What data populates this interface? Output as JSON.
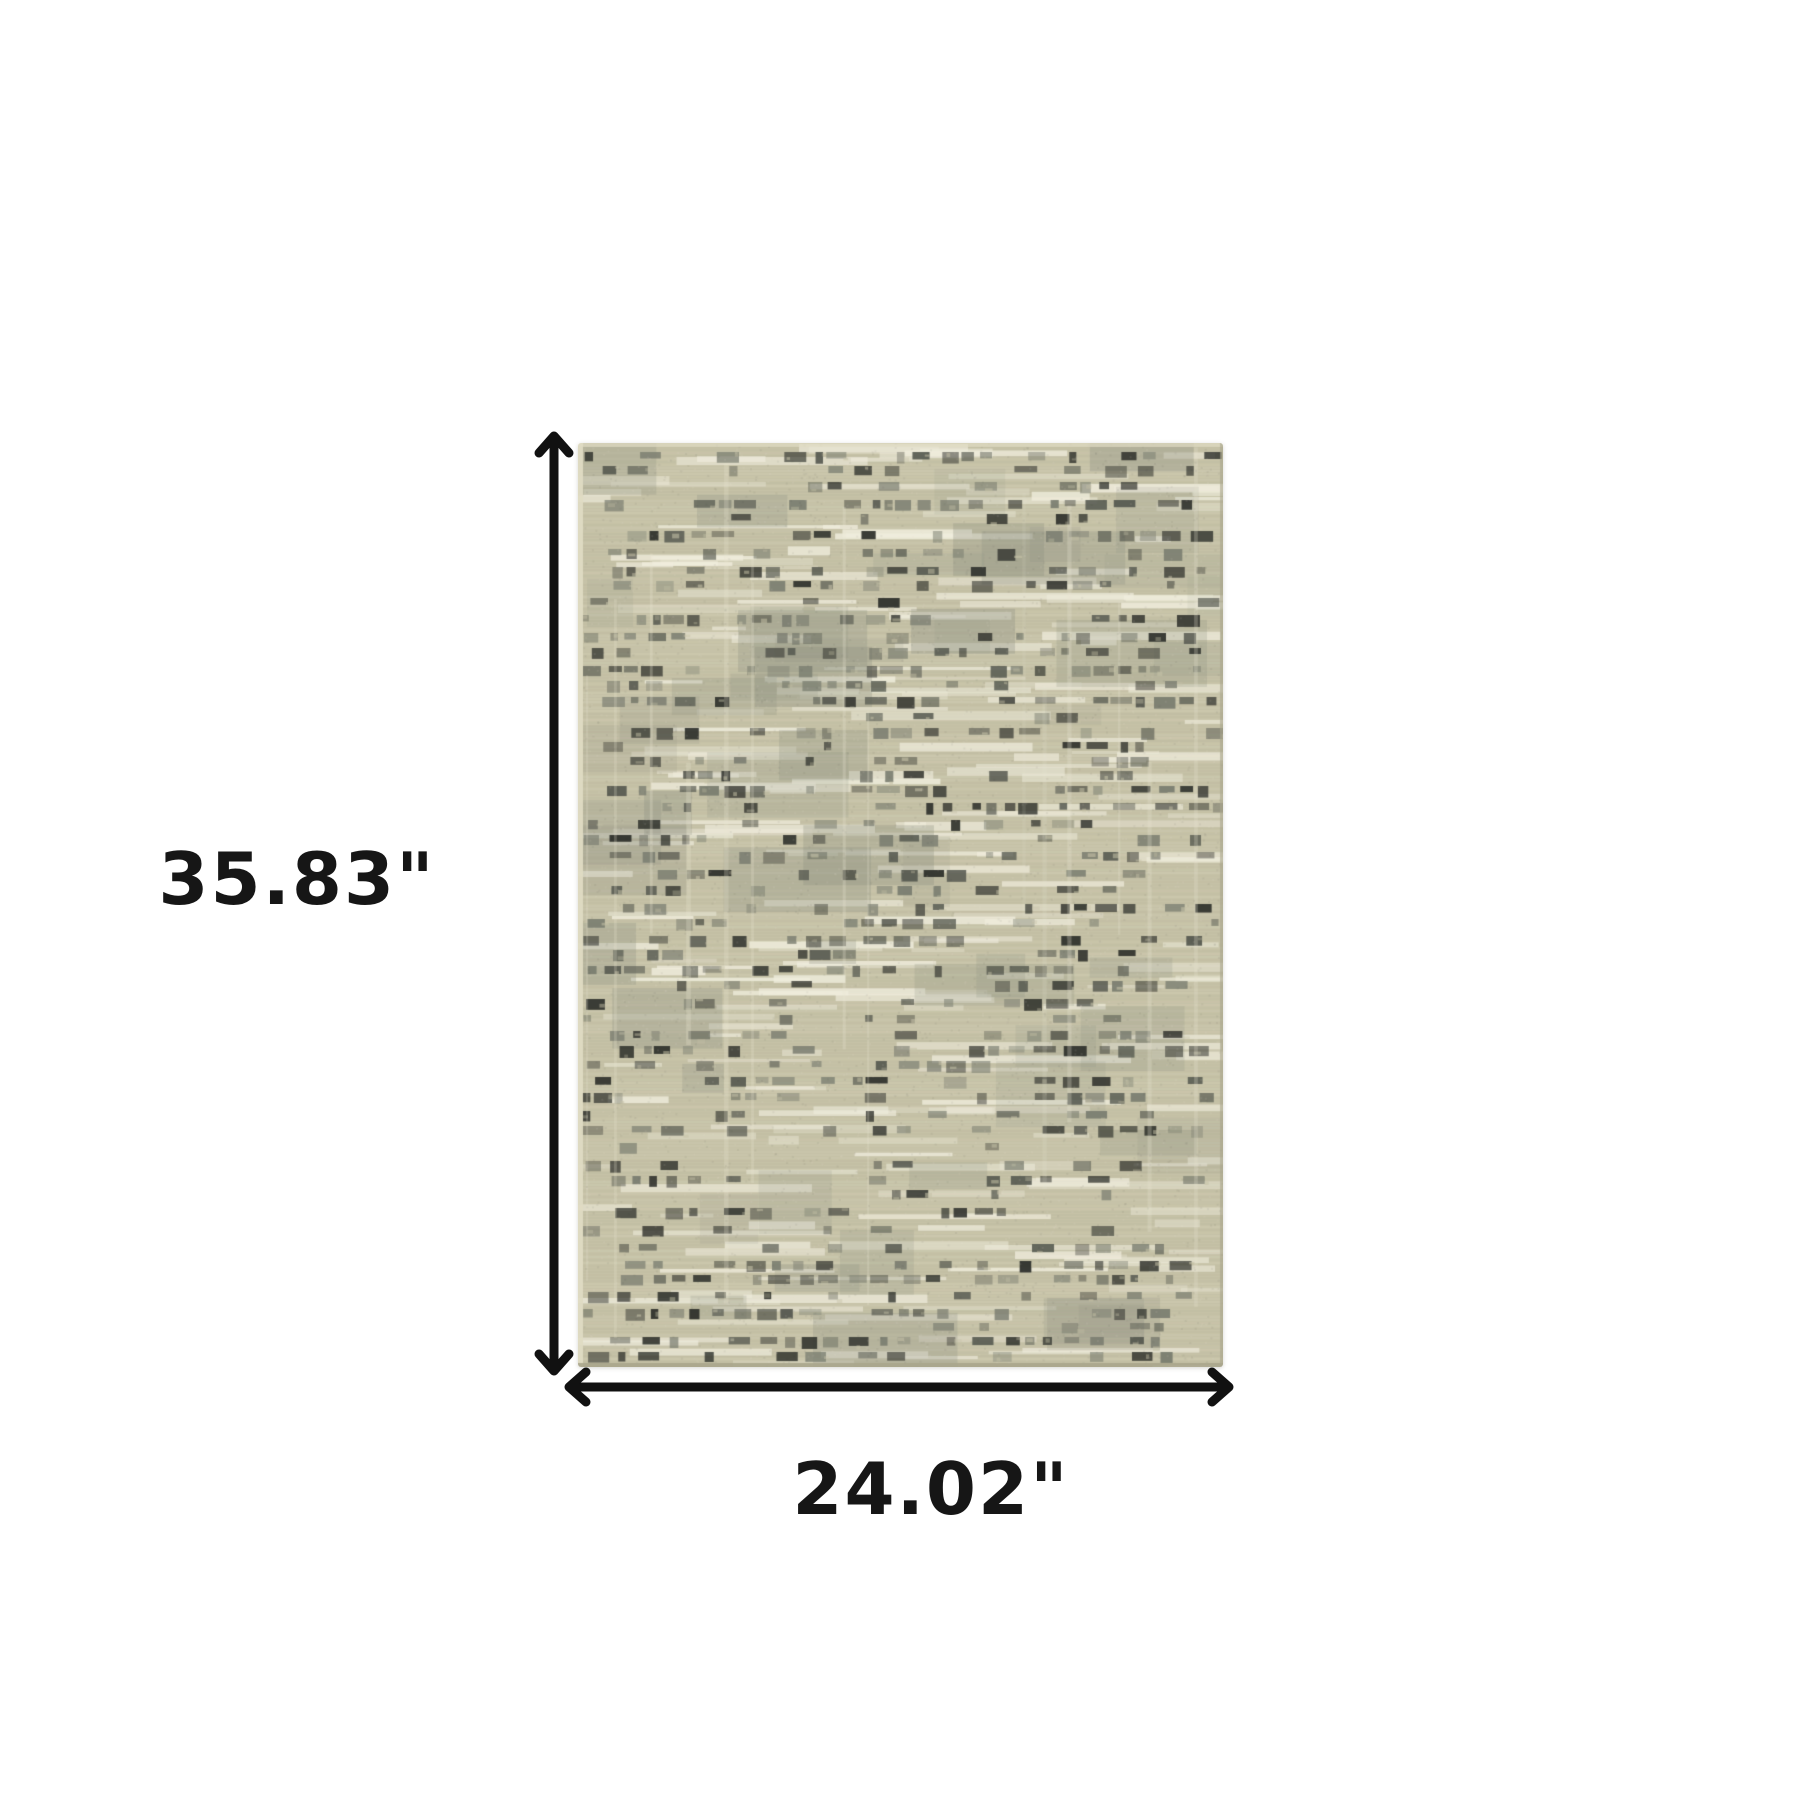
{
  "dimensions": {
    "height_label": "35.83\"",
    "width_label": "24.02\"",
    "height_inches": 35.83,
    "width_inches": 24.02,
    "unit": "inches"
  },
  "style": {
    "background": "#ffffff",
    "annotation_color": "#111111",
    "label_text_color": "#161616"
  },
  "rug": {
    "seed": 7,
    "palette": {
      "base": "#c6c2a7",
      "light": "#e9e5d2",
      "ivory": "#f0eddd",
      "dark": "#2f312c",
      "mid": "#565950",
      "olive": "#7a7d70",
      "gray_patch": "#8b8f80",
      "edge_light": "#dfdbc3",
      "edge_dark": "#a9a58c"
    }
  }
}
